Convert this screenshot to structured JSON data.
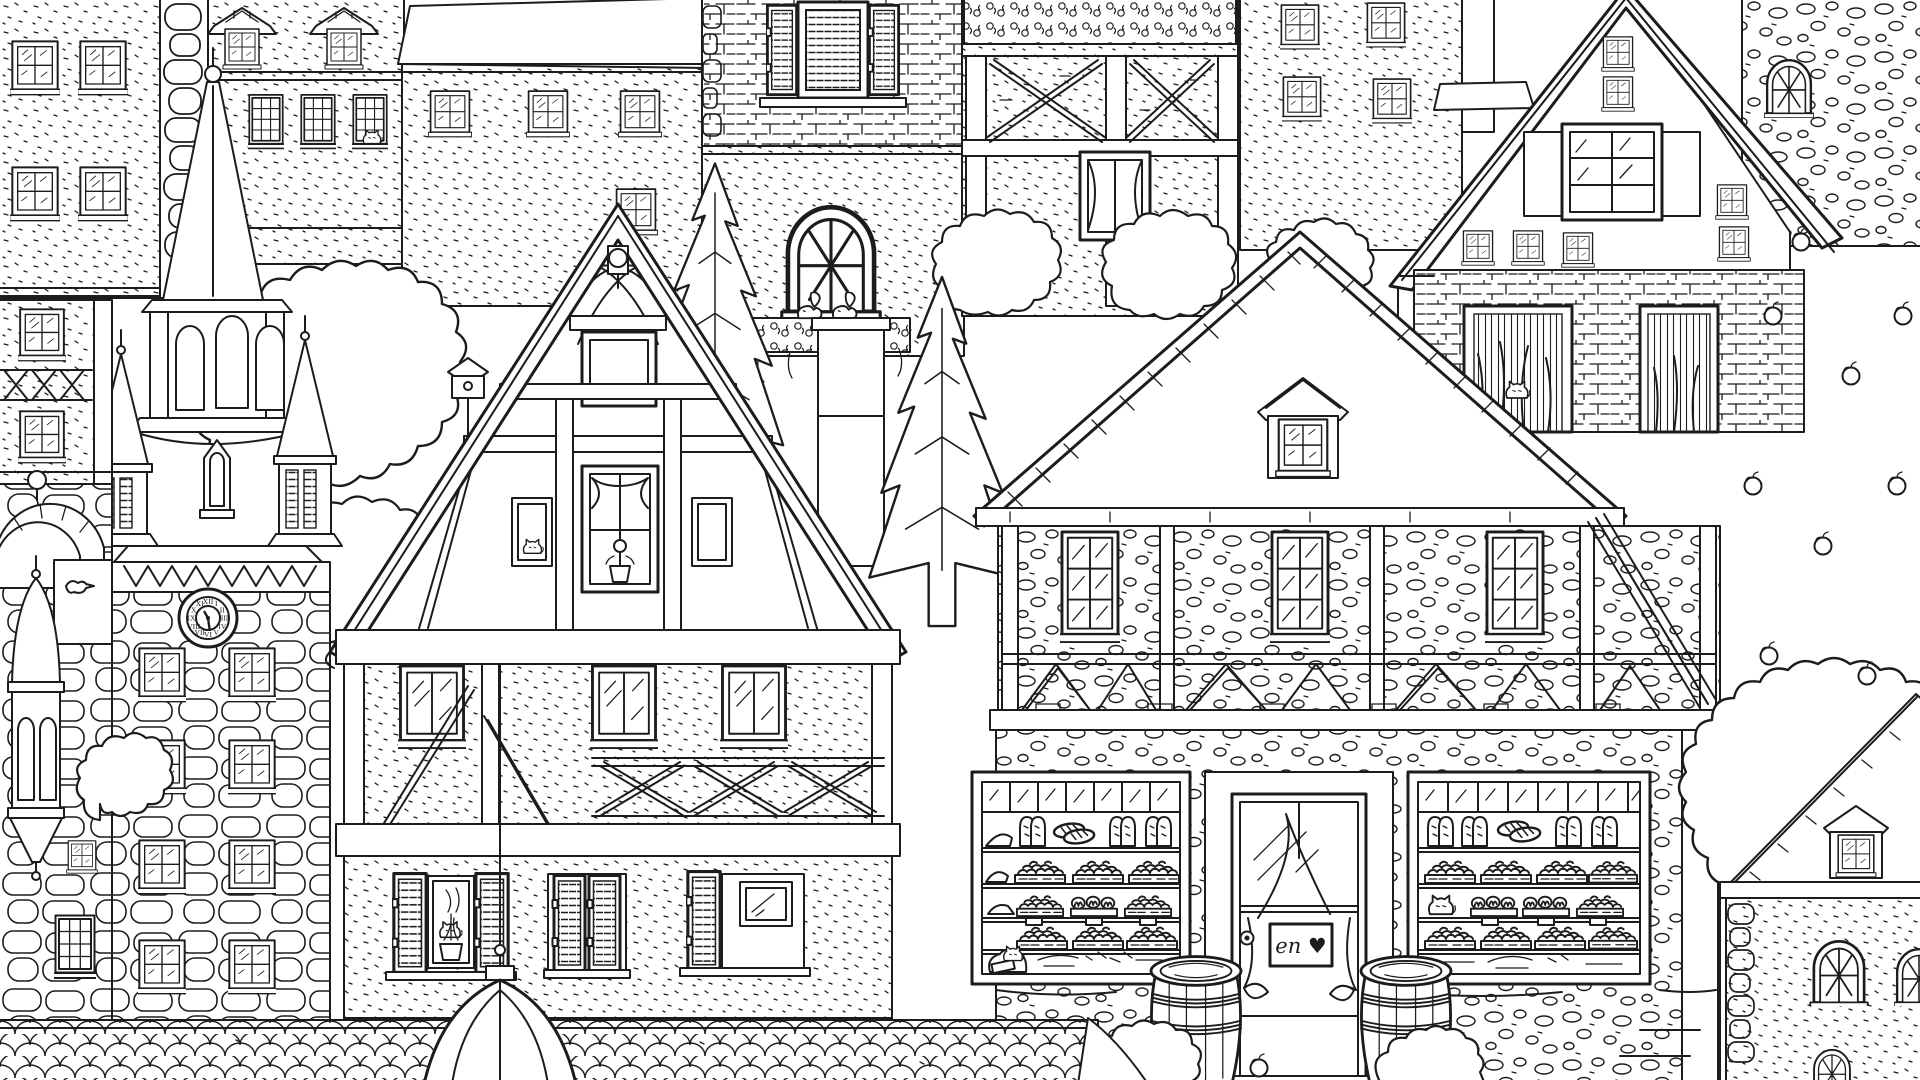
{
  "scene": {
    "title": "Old European town street — black and white coloring-book line illustration",
    "style": "hand-drawn outline art, no color fills",
    "palette": {
      "line": "#1c1c1c",
      "background": "#ffffff"
    },
    "elements": [
      {
        "name": "stucco-apartment-left",
        "label": "speckled stucco building with paired four-pane windows, top-left corner"
      },
      {
        "name": "stone-quoin-strip",
        "label": "column of large rounded quoin stones"
      },
      {
        "name": "dormer-roof-building",
        "label": "building with two hip-roofed dormer windows and three twelve-pane sash windows, cat in one window"
      },
      {
        "name": "church-spire",
        "label": "tall shingled church spire with ball finial"
      },
      {
        "name": "belfry",
        "label": "octagonal belfry with arched louvered openings and flared speckled skirt roof"
      },
      {
        "name": "corner-turrets",
        "label": "two small pointed turrets flanking the belfry"
      },
      {
        "name": "clock-tower",
        "label": "stone clock tower with zigzag cornice, clock face and eight four-pane windows"
      },
      {
        "name": "half-timbered-annex-left",
        "label": "narrow half-timbered facade with X-braced balcony rail, far left"
      },
      {
        "name": "stone-arch-wall",
        "label": "stone arch bridge wall with dark arched opening and ball ornament"
      },
      {
        "name": "oriel-turret",
        "label": "small oriel bay with conical roof and pyramid base hanging on left wall"
      },
      {
        "name": "foliage-left",
        "label": "large leafy tree mass between spire and gabled house"
      },
      {
        "name": "birdhouse",
        "label": "birdhouse on a pole in the foliage"
      },
      {
        "name": "shingle-roof-house",
        "label": "house with fish-scale shingle roof band and small four-pane windows, top centre"
      },
      {
        "name": "brick-house-arched-window",
        "label": "brick building with louvre-shuttered window and arched window with flower box and squirrel"
      },
      {
        "name": "timber-frame-facade-top",
        "label": "half-timbered facade with swirling beams, X panels, curtained window and flower box on top edge"
      },
      {
        "name": "stucco-house-small-windows",
        "label": "speckled house with four small four-pane windows"
      },
      {
        "name": "plank-gable-house",
        "label": "steep A-frame house with vertical plank gable, stacked windows and plank-shuttered six-pane window"
      },
      {
        "name": "brick-base-plant-openings",
        "label": "brick ground floor with two plant-filled openings and a sitting cat"
      },
      {
        "name": "cobblestone-wall-top-right",
        "label": "round-cobble stone wall with arched multi-pane window, top right"
      },
      {
        "name": "fir-trees",
        "label": "two tall fir trees in the middle of the scene"
      },
      {
        "name": "chimney-pillar",
        "label": "brick-and-stone pillar with squirrel sitting on its cap"
      },
      {
        "name": "fachwerk-gable-house",
        "label": "large half-timbered gabled house with wavy wood-grain beams and ball finial"
      },
      {
        "name": "attic-opening",
        "label": "small framed attic opening in the gable"
      },
      {
        "name": "curtain-window",
        "label": "gable window with swag curtain and potted flower"
      },
      {
        "name": "cat-at-small-window",
        "label": "cat sitting in a small gable window"
      },
      {
        "name": "casement-windows",
        "label": "three two-pane casement windows on the middle floor"
      },
      {
        "name": "x-brace-band",
        "label": "band of X-shaped timber braces"
      },
      {
        "name": "shuttered-windows",
        "label": "three ground-floor windows with louvered shutters, plant and cat"
      },
      {
        "name": "downpipe-rod",
        "label": "thin rod running from the beam down to the scalloped dome"
      },
      {
        "name": "bakery-building",
        "label": "bakery with large pantile roof, dormer, timber braces and shop front"
      },
      {
        "name": "bakery-roof-dormer",
        "label": "small gabled dormer window on the bakery roof"
      },
      {
        "name": "bakery-display-window-left",
        "label": "left shop display window with shelves of breads, buns and a flour sack with cat"
      },
      {
        "name": "bakery-display-window-right",
        "label": "right shop display window with shelves of breads, pretzel rolls and a cat"
      },
      {
        "name": "bakery-door",
        "label": "glass shop door in swirled wood frame with curtain, handle and heart sign"
      },
      {
        "name": "door-sign",
        "label": "hanging sign with cursive lettering and heart"
      },
      {
        "name": "wooden-barrels",
        "label": "two wooden stave barrels with hoops in front of the bakery"
      },
      {
        "name": "bushes-with-apple",
        "label": "low scribbled bushes with a fallen apple"
      },
      {
        "name": "apple-tree",
        "label": "big leafy apple tree with round apples, right side"
      },
      {
        "name": "stone-cottage",
        "label": "stone cottage with hatched roof, tiny dormer and arched windows, bottom right"
      },
      {
        "name": "fish-scale-band",
        "label": "foreground band of fish-scale roof shingles across the bottom"
      },
      {
        "name": "scalloped-dome",
        "label": "scaled bell-shaped dome roof rising in the foreground"
      }
    ]
  },
  "clock": {
    "numerals": [
      "XII",
      "I",
      "II",
      "III",
      "IV",
      "V",
      "VI",
      "VII",
      "VIII",
      "IX",
      "X",
      "XI"
    ],
    "hour_angle": 330,
    "minute_angle": 172,
    "time_hint": "hands pointing roughly half past four"
  },
  "door_sign": {
    "text": "en ♥"
  }
}
